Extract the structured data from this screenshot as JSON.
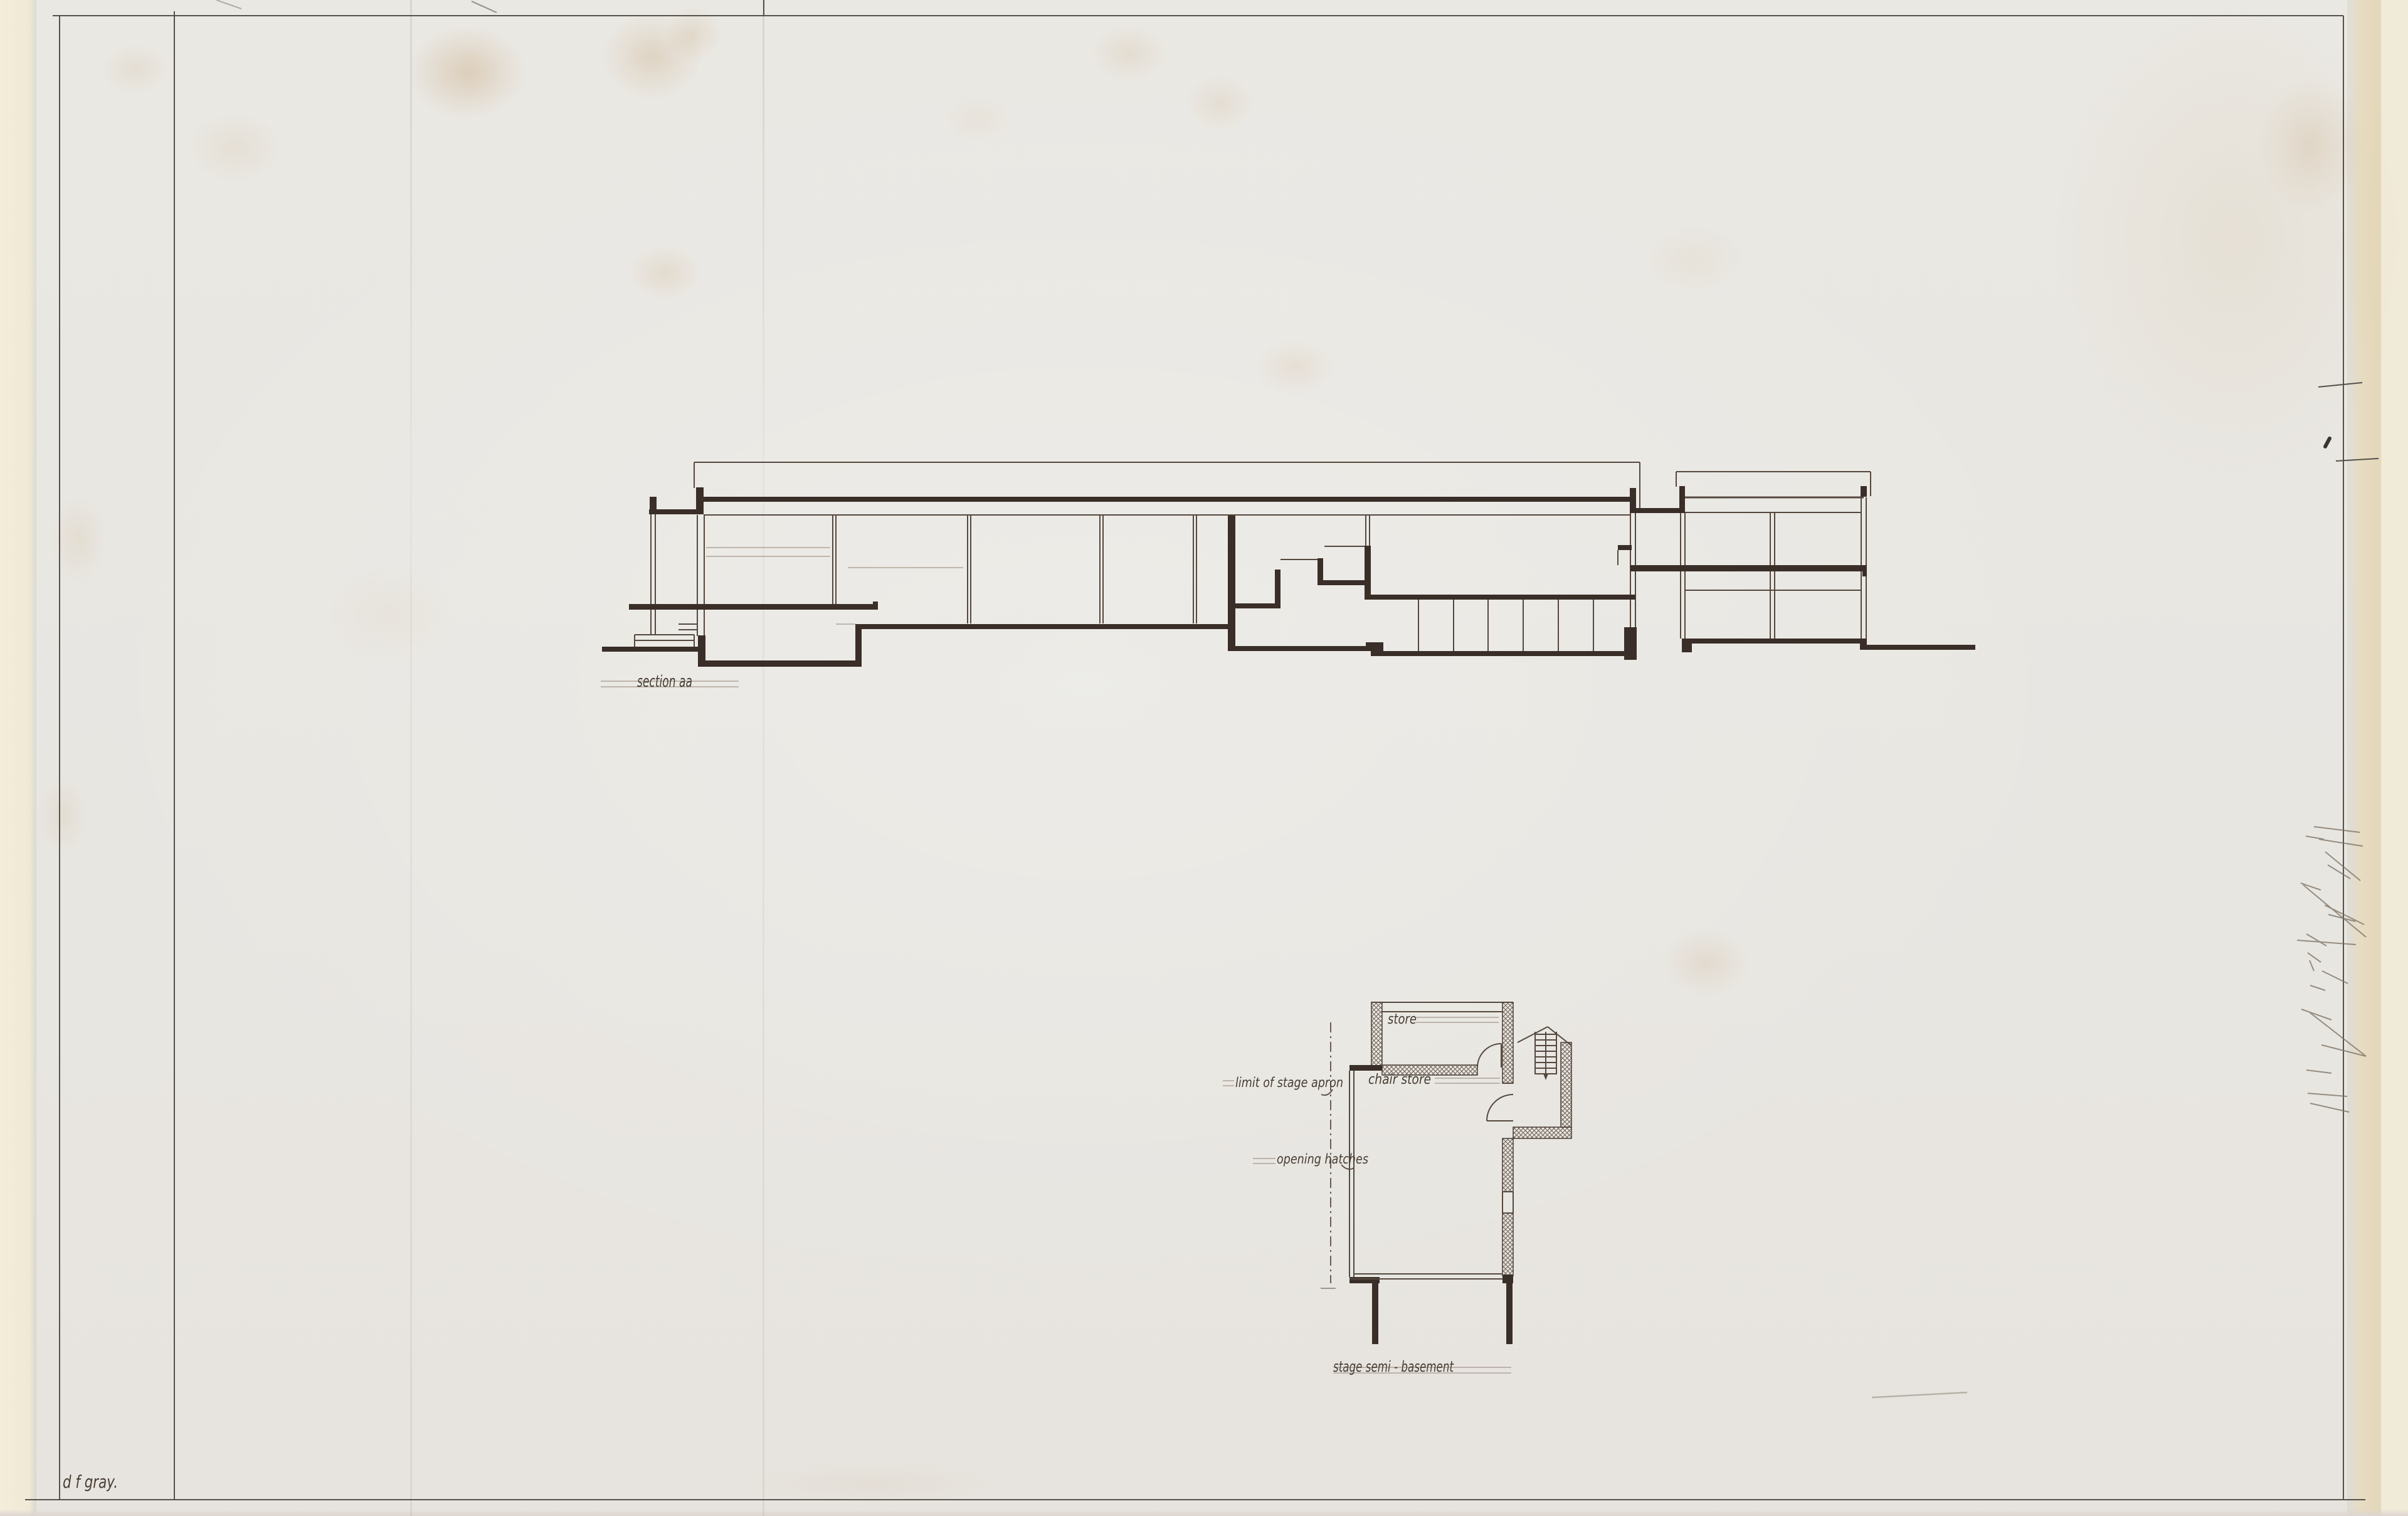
{
  "sheet": {
    "type": "architectural-section-and-plan-drawing",
    "figures": {
      "section": {
        "title": "section aa"
      },
      "plan": {
        "title": "stage semi - basement",
        "room_labels": {
          "store": "store",
          "chair_store": "chair store"
        },
        "annotations": {
          "stage_apron": "limit of stage apron",
          "hatches": "opening hatches"
        }
      }
    },
    "signature": "d f gray.",
    "colors": {
      "paper": "#e9e6e1",
      "paper_edge": "#f1ebd9",
      "ink_heavy": "#3a2e28",
      "ink_thin": "#54483e",
      "ink_faint": "#a2968a",
      "pencil": "#7a6e60",
      "stain": "#c8a068"
    }
  }
}
